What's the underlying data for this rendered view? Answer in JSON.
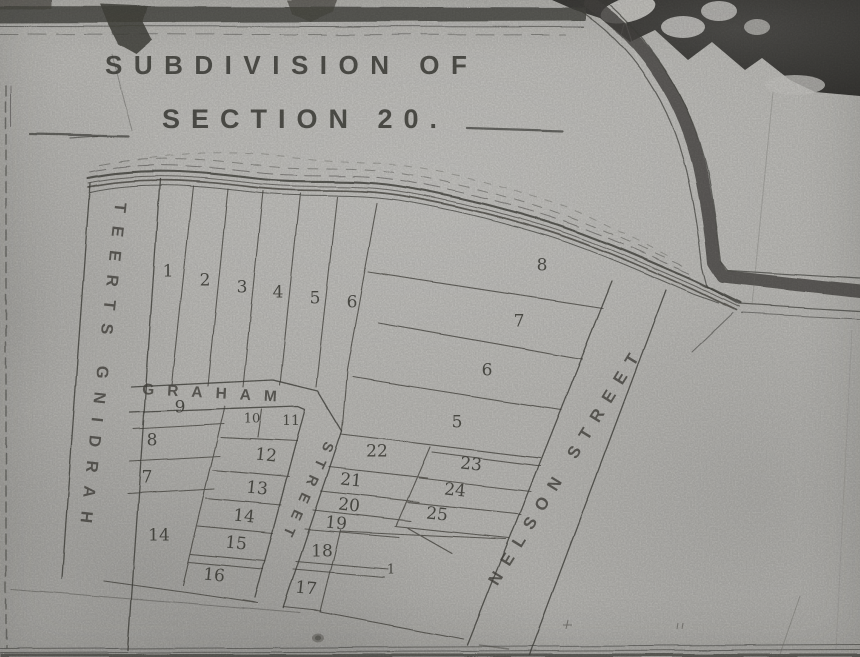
{
  "map": {
    "title_line1": "SUBDIVISION OF",
    "title_line2": "SECTION 20.",
    "streets": {
      "harding": "HARDING STREET",
      "graham_word": "GRAHAM",
      "graham_street_word": "STREET",
      "nelson": "NELSON STREET"
    },
    "lots": [
      {
        "n": "1",
        "x": 168,
        "y": 272
      },
      {
        "n": "2",
        "x": 205,
        "y": 281
      },
      {
        "n": "3",
        "x": 242,
        "y": 288
      },
      {
        "n": "4",
        "x": 278,
        "y": 293
      },
      {
        "n": "5",
        "x": 315,
        "y": 299
      },
      {
        "n": "6",
        "x": 352,
        "y": 303
      },
      {
        "n": "8",
        "x": 542,
        "y": 266
      },
      {
        "n": "7",
        "x": 519,
        "y": 322
      },
      {
        "n": "6",
        "x": 487,
        "y": 371
      },
      {
        "n": "5",
        "x": 457,
        "y": 423
      },
      {
        "n": "9",
        "x": 180,
        "y": 408
      },
      {
        "n": "10",
        "x": 252,
        "y": 419,
        "fs": 13
      },
      {
        "n": "11",
        "x": 291,
        "y": 421,
        "fs": 14
      },
      {
        "n": "8",
        "x": 152,
        "y": 441
      },
      {
        "n": "12",
        "x": 266,
        "y": 456,
        "r": 6
      },
      {
        "n": "7",
        "x": 147,
        "y": 478
      },
      {
        "n": "13",
        "x": 257,
        "y": 489,
        "r": 6
      },
      {
        "n": "14",
        "x": 244,
        "y": 517,
        "r": 6
      },
      {
        "n": "15",
        "x": 236,
        "y": 544,
        "r": 6
      },
      {
        "n": "16",
        "x": 214,
        "y": 576,
        "r": 6
      },
      {
        "n": "14",
        "x": 159,
        "y": 536
      },
      {
        "n": "22",
        "x": 377,
        "y": 452
      },
      {
        "n": "21",
        "x": 351,
        "y": 481,
        "r": 6
      },
      {
        "n": "20",
        "x": 349,
        "y": 506,
        "r": 6
      },
      {
        "n": "19",
        "x": 336,
        "y": 524,
        "r": 6
      },
      {
        "n": "18",
        "x": 322,
        "y": 552
      },
      {
        "n": "17",
        "x": 306,
        "y": 589,
        "r": 6
      },
      {
        "n": "23",
        "x": 471,
        "y": 465,
        "r": 6
      },
      {
        "n": "24",
        "x": 455,
        "y": 491,
        "r": 6
      },
      {
        "n": "25",
        "x": 437,
        "y": 515,
        "r": 6
      },
      {
        "n": "1",
        "x": 391,
        "y": 570,
        "fs": 13
      }
    ]
  },
  "colors": {
    "paper": "#c6c5c1",
    "ink": "#45443f",
    "border_band": "#4a4944",
    "photo_backing": "#44433f",
    "torn_paper": "#dbdad6"
  }
}
